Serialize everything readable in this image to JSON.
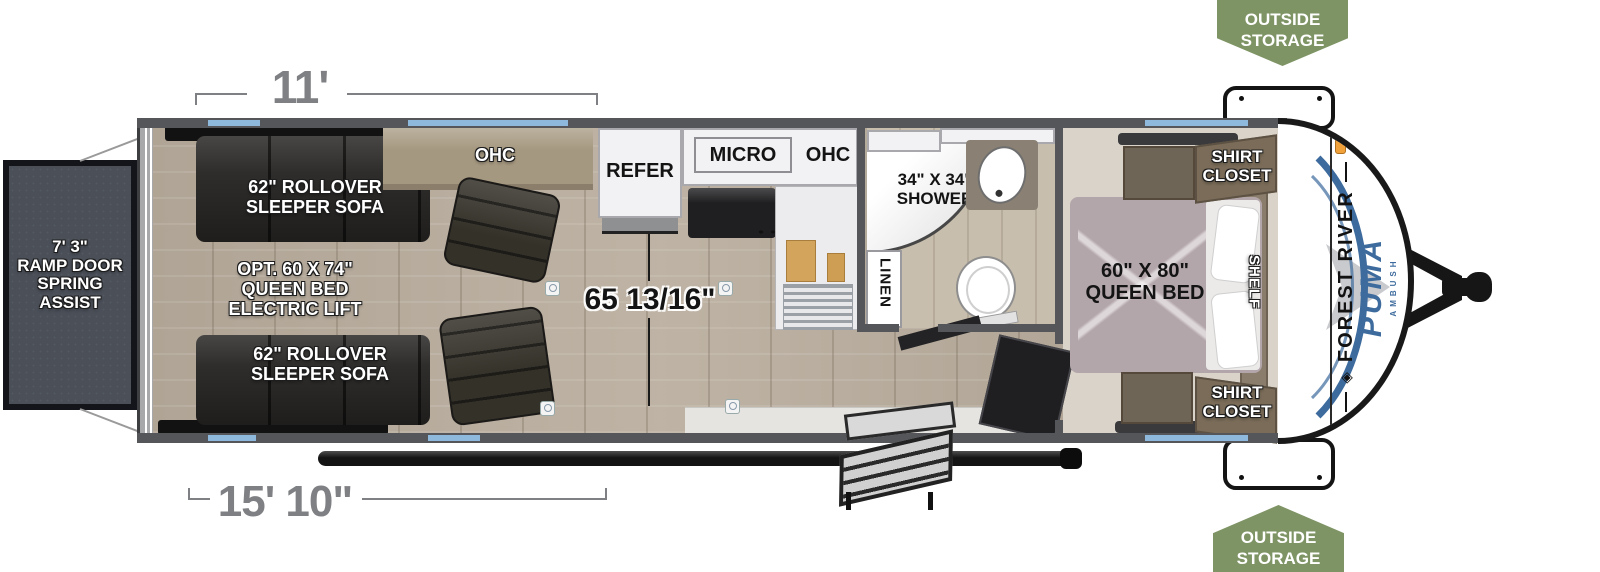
{
  "fp": {
    "badge_top": [
      "OUTSIDE",
      "STORAGE"
    ],
    "badge_bottom": [
      "OUTSIDE",
      "STORAGE"
    ],
    "dims": {
      "top": "11'",
      "bottom": "15' 10\"",
      "height": "65 13/16\""
    },
    "ramp": [
      "7' 3\"",
      "RAMP DOOR",
      "SPRING",
      "ASSIST"
    ],
    "garage": {
      "sofa_top": [
        "62\" ROLLOVER",
        "SLEEPER SOFA"
      ],
      "sofa_bottom": [
        "62\" ROLLOVER",
        "SLEEPER SOFA"
      ],
      "opt": [
        "OPT. 60 X 74\"",
        "QUEEN BED",
        "ELECTRIC LIFT"
      ],
      "ohc": "OHC"
    },
    "kitchen": {
      "refer": "REFER",
      "micro": "MICRO",
      "ohc": "OHC"
    },
    "bath": {
      "shower": [
        "34\" X 34\"",
        "SHOWER"
      ],
      "linen": "LINEN"
    },
    "bedroom": {
      "bed": [
        "60\" X 80\"",
        "QUEEN BED"
      ],
      "closet_top": [
        "SHIRT",
        "CLOSET"
      ],
      "closet_bottom": [
        "SHIRT",
        "CLOSET"
      ],
      "shelf": "SHELF"
    },
    "cap": {
      "brand": "FOREST RIVER",
      "model": "PUMA",
      "sub": "AMBUSH"
    }
  },
  "colors": {
    "badge_green": "#7E9465",
    "wall_gray": "#54565A",
    "window_blue": "#8FB9DC",
    "brand_blue": "#3D6B9D",
    "dim_gray": "#7F8083"
  }
}
